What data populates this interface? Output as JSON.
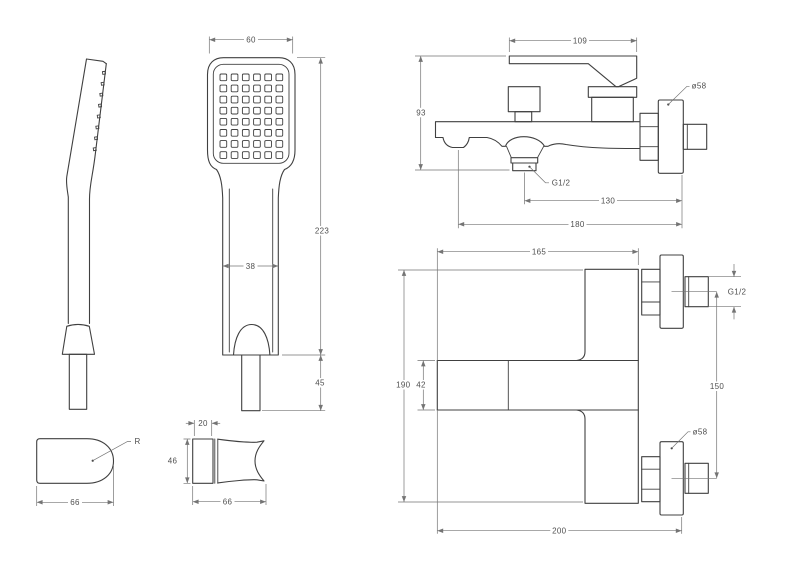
{
  "drawing": {
    "background_color": "#ffffff",
    "line_color": "#404040",
    "dim_color": "#747474",
    "views": {
      "hand_shower_front": {
        "head_width": "60",
        "total_height": "223",
        "handle_width": "38",
        "connector_length": "45",
        "nozzle_grid": {
          "columns": 6,
          "rows": 8
        }
      },
      "mixer_side": {
        "lever_length": "109",
        "body_height": "93",
        "flange_diameter": "ø58",
        "outlet_thread": "G1/2",
        "outlet_to_wall": "130",
        "spout_to_wall": "180"
      },
      "mixer_front": {
        "body_width": "165",
        "overall_height": "190",
        "spout_height": "42",
        "connection_spacing": "150",
        "connection_thread": "G1/2",
        "flange_diameter": "ø58",
        "overall_width": "200"
      },
      "bracket_top": {
        "radius_label": "R",
        "width": "66"
      },
      "bracket_side": {
        "plate_depth": "20",
        "height": "46",
        "width": "66"
      }
    }
  }
}
